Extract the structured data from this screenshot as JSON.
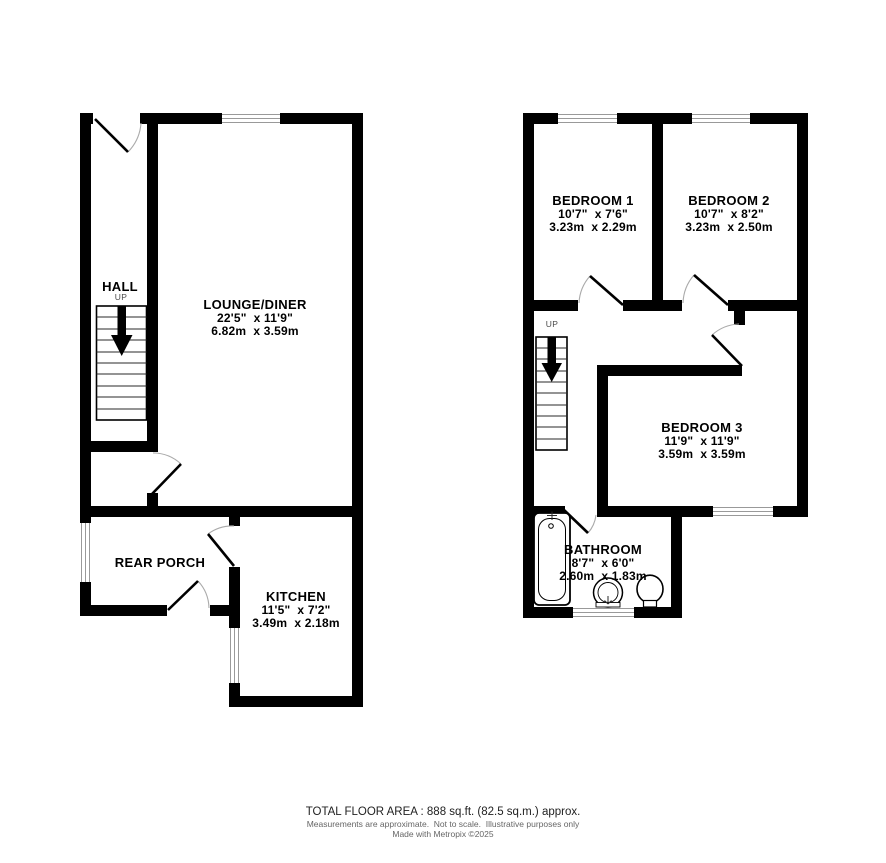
{
  "ground_floor": {
    "hall": {
      "name": "HALL",
      "up": "UP"
    },
    "lounge": {
      "name": "LOUNGE/DINER",
      "imperial": "22'5\"  x 11'9\"",
      "metric": "6.82m  x 3.59m"
    },
    "porch": {
      "name": "REAR PORCH"
    },
    "kitchen": {
      "name": "KITCHEN",
      "imperial": "11'5\"  x 7'2\"",
      "metric": "3.49m  x 2.18m"
    }
  },
  "first_floor": {
    "up": "UP",
    "bedroom1": {
      "name": "BEDROOM 1",
      "imperial": "10'7\"  x 7'6\"",
      "metric": "3.23m  x 2.29m"
    },
    "bedroom2": {
      "name": "BEDROOM 2",
      "imperial": "10'7\"  x 8'2\"",
      "metric": "3.23m  x 2.50m"
    },
    "bedroom3": {
      "name": "BEDROOM 3",
      "imperial": "11'9\"  x 11'9\"",
      "metric": "3.59m  x 3.59m"
    },
    "bathroom": {
      "name": "BATHROOM",
      "imperial": "8'7\"  x 6'0\"",
      "metric": "2.60m  x 1.83m"
    }
  },
  "footer": {
    "total_area": "TOTAL FLOOR AREA : 888 sq.ft. (82.5 sq.m.) approx.",
    "disclaimer": "Measurements are approximate.  Not to scale.  Illustrative purposes only",
    "credit": "Made with Metropix ©2025"
  },
  "colors": {
    "wall": "#000000",
    "background": "#ffffff",
    "window_line": "#999999",
    "door_arc": "#aaaaaa"
  }
}
